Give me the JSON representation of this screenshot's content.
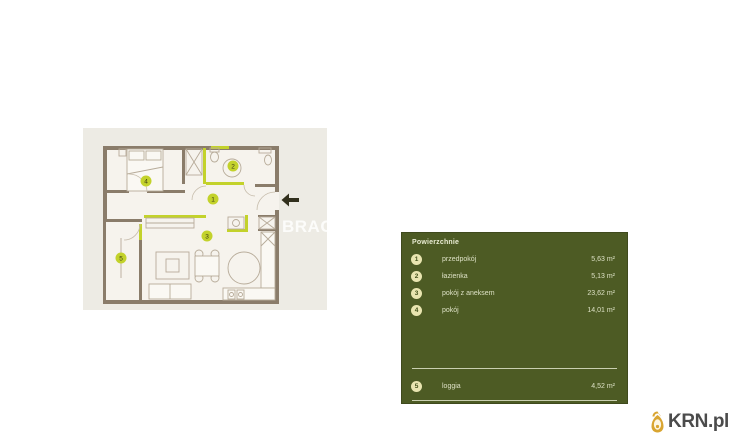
{
  "floorplan": {
    "watermark": "BRAC",
    "room_numbers": [
      "1",
      "2",
      "3",
      "4",
      "5"
    ],
    "accent_color": "#c3d22b",
    "wall_color": "#8a7c6a",
    "floor_color": "#f6f3ed",
    "backdrop_color": "#edebe4"
  },
  "panel": {
    "title": "Powierzchnie",
    "background_color": "#4d5b24",
    "badge_color": "#e9e5b0",
    "rows": [
      {
        "num": "1",
        "label": "przedpokój",
        "value": "5,63 m²"
      },
      {
        "num": "2",
        "label": "łazienka",
        "value": "5,13 m²"
      },
      {
        "num": "3",
        "label": "pokój z aneksem",
        "value": "23,62 m²"
      },
      {
        "num": "4",
        "label": "pokój",
        "value": "14,01 m²"
      }
    ],
    "footer": {
      "num": "5",
      "label": "loggia",
      "value": "4,52 m²"
    }
  },
  "logo": {
    "text": "KRN.pl",
    "icon_color": "#d9a531"
  }
}
